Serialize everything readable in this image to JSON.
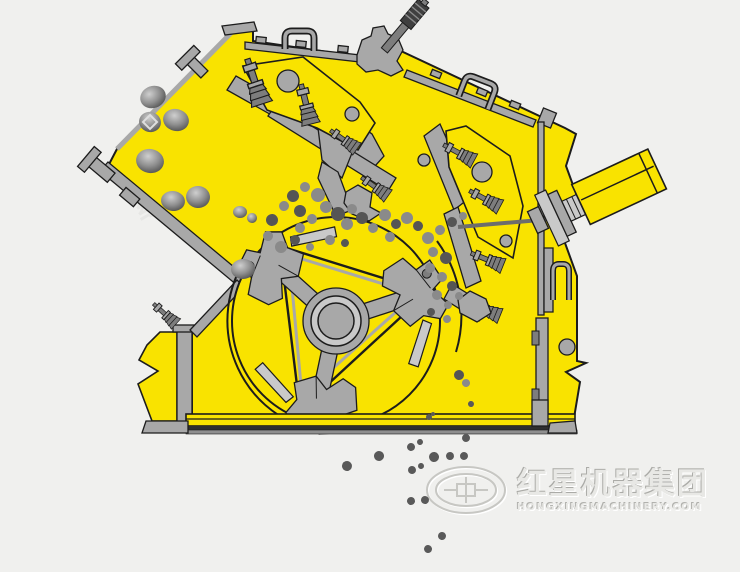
{
  "watermark": {
    "brand_cn": "红星机器集团",
    "brand_en": "HONGXINGMACHINERY.COM"
  },
  "colors": {
    "background": "#f0f0ee",
    "machine_yellow": "#f9e300",
    "steel": "#a8a8a8",
    "steel_light": "#c9c9c9",
    "steel_dark": "#7d7d7d",
    "outline": "#1c1c1c",
    "rock_mid": "#8a8a8a",
    "rock_dark": "#555555",
    "particle": "#595959",
    "base_stripe": "#2e2e2e",
    "watermark_ink": "#e8e8e5"
  },
  "components": [
    "feed-chute",
    "feed-rocks",
    "machine-frame",
    "upper-apron-assembly",
    "lower-apron-assembly",
    "spring-bolts",
    "rotor-assembly",
    "blow-bar-hammers",
    "rotor-hub",
    "crushing-chamber",
    "hydraulic-cylinder",
    "tie-rod",
    "side-wall-details",
    "base-plate",
    "support-feet",
    "discharge-particles",
    "brand-watermark"
  ],
  "rocks": {
    "feed": [
      [
        153,
        97,
        13,
        11
      ],
      [
        150,
        122,
        11,
        10
      ],
      [
        176,
        120,
        13,
        11
      ],
      [
        150,
        161,
        14,
        12
      ],
      [
        173,
        201,
        12,
        10
      ],
      [
        198,
        197,
        12,
        11
      ],
      [
        240,
        212,
        7,
        6
      ],
      [
        252,
        218,
        5,
        5
      ],
      [
        243,
        269,
        12,
        10
      ]
    ],
    "chamber": [
      [
        293,
        196,
        6
      ],
      [
        305,
        187,
        5
      ],
      [
        318,
        195,
        7
      ],
      [
        300,
        211,
        6
      ],
      [
        312,
        219,
        5
      ],
      [
        326,
        207,
        6
      ],
      [
        338,
        214,
        7
      ],
      [
        352,
        209,
        5
      ],
      [
        347,
        224,
        6
      ],
      [
        362,
        218,
        6
      ],
      [
        373,
        228,
        5
      ],
      [
        385,
        215,
        6
      ],
      [
        396,
        224,
        5
      ],
      [
        407,
        218,
        6
      ],
      [
        390,
        237,
        5
      ],
      [
        418,
        226,
        5
      ],
      [
        300,
        228,
        5
      ],
      [
        284,
        206,
        5
      ],
      [
        272,
        220,
        6
      ],
      [
        268,
        236,
        5
      ],
      [
        281,
        247,
        6
      ],
      [
        295,
        240,
        5
      ],
      [
        310,
        247,
        4
      ],
      [
        330,
        240,
        5
      ],
      [
        345,
        243,
        4
      ],
      [
        428,
        238,
        6
      ],
      [
        440,
        230,
        5
      ],
      [
        452,
        222,
        5
      ],
      [
        463,
        216,
        4
      ],
      [
        433,
        252,
        5
      ],
      [
        446,
        258,
        6
      ],
      [
        430,
        268,
        5
      ],
      [
        442,
        277,
        5
      ],
      [
        452,
        286,
        5
      ],
      [
        437,
        295,
        5
      ],
      [
        448,
        305,
        4
      ],
      [
        431,
        312,
        4
      ],
      [
        447,
        319,
        4
      ],
      [
        459,
        296,
        4
      ],
      [
        459,
        375,
        5
      ],
      [
        466,
        383,
        4
      ]
    ],
    "discharge": [
      [
        347,
        466,
        5
      ],
      [
        379,
        456,
        5
      ],
      [
        411,
        447,
        4
      ],
      [
        420,
        442,
        3
      ],
      [
        434,
        457,
        5
      ],
      [
        450,
        456,
        4
      ],
      [
        464,
        456,
        4
      ],
      [
        466,
        438,
        4
      ],
      [
        412,
        470,
        4
      ],
      [
        421,
        466,
        3
      ],
      [
        471,
        404,
        3
      ],
      [
        429,
        417,
        3
      ],
      [
        433,
        414,
        2
      ],
      [
        411,
        501,
        4
      ],
      [
        425,
        500,
        4
      ],
      [
        442,
        536,
        4
      ],
      [
        428,
        549,
        4
      ]
    ]
  }
}
